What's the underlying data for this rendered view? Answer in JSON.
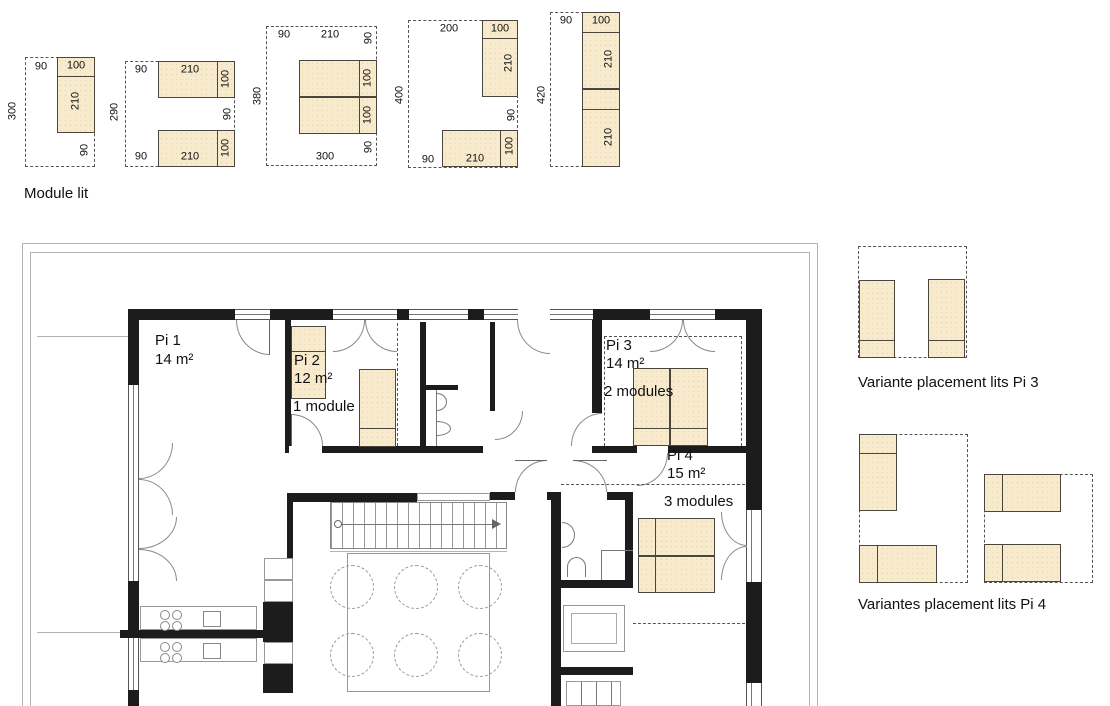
{
  "legend": {
    "title": "Module lit"
  },
  "dims": [
    "90",
    "100",
    "210",
    "300",
    "90",
    "90",
    "210",
    "100",
    "290",
    "90",
    "90",
    "210",
    "100",
    "90",
    "210",
    "90",
    "380",
    "100",
    "100",
    "300",
    "90",
    "200",
    "100",
    "210",
    "400",
    "90",
    "90",
    "210",
    "100",
    "90",
    "100",
    "210",
    "420",
    "210"
  ],
  "rooms": {
    "pi1": {
      "name": "Pi 1",
      "area": "14 m²"
    },
    "pi2": {
      "name": "Pi 2",
      "area": "12 m²",
      "modules": "1 module"
    },
    "pi3": {
      "name": "Pi 3",
      "area": "14 m²",
      "modules": "2 modules"
    },
    "pi4": {
      "name": "Pi 4",
      "area": "15 m²",
      "modules": "3 modules"
    }
  },
  "variants": {
    "pi3_caption": "Variante placement lits Pi 3",
    "pi4_caption": "Variantes placement lits Pi 4"
  },
  "colors": {
    "bed_fill": "#f8ebcd",
    "bed_border": "#4a463c",
    "wall": "#1c1c1c",
    "dashed_line": "#555555",
    "terrace_line": "#b3b3b3"
  }
}
